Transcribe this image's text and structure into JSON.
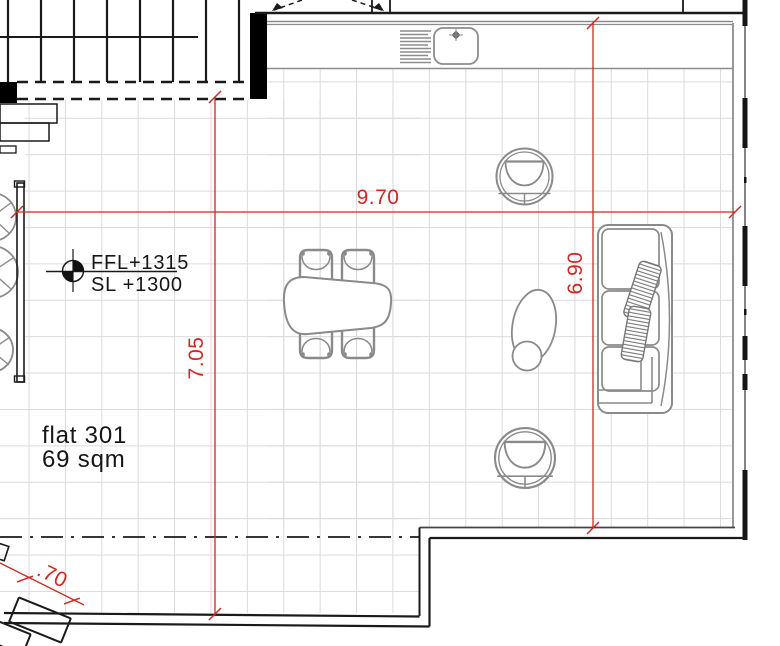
{
  "plan": {
    "unit_label": "flat 301",
    "unit_area": "69 sqm",
    "level_line1": "FFL+1315",
    "level_line2": "SL +1300",
    "dim_width": "9.70",
    "dim_height_left": "7.05",
    "dim_height_right": "6.90",
    "dim_offset": ".70"
  },
  "colors": {
    "dimension": "#d02822",
    "grid": "#dbdbdb",
    "line": "#1a1a1a",
    "furniture": "#8a8a8a"
  },
  "icons": {
    "level_marker": "survey-level-icon",
    "sink": "kitchen-sink-icon",
    "faucet": "faucet-icon"
  }
}
